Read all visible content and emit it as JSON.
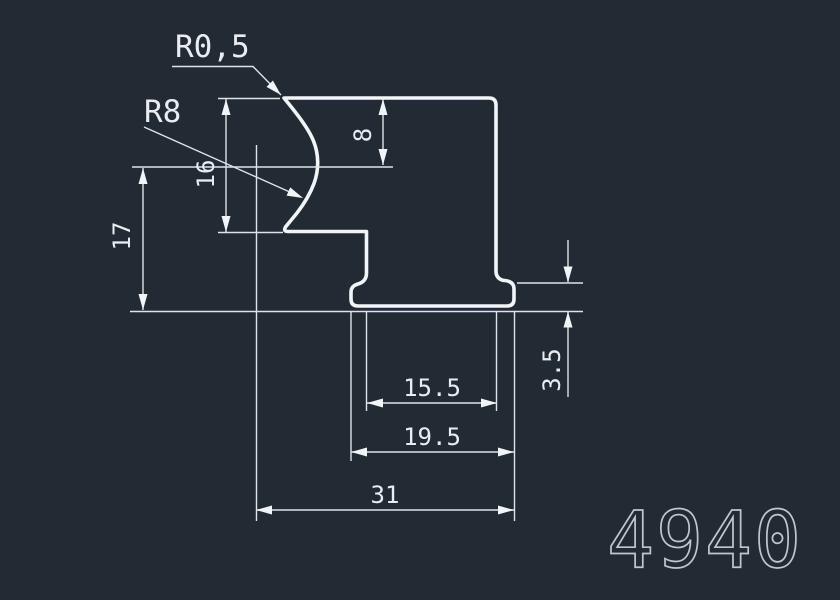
{
  "drawing": {
    "labels": {
      "radius_tip": "R0,5",
      "radius_groove": "R8"
    },
    "dimensions": {
      "upper_height": "16",
      "left_height": "17",
      "top_depth": "8",
      "foot_height": "3.5",
      "body_width": "15.5",
      "foot_width": "19.5",
      "overall_width": "31"
    },
    "part_number": "4940",
    "colors": {
      "background": "#222a34",
      "line": "#f2f5f7",
      "dim_line": "#dde3e8",
      "text": "#e9edf1",
      "part_number": "#bfc6cd"
    }
  }
}
